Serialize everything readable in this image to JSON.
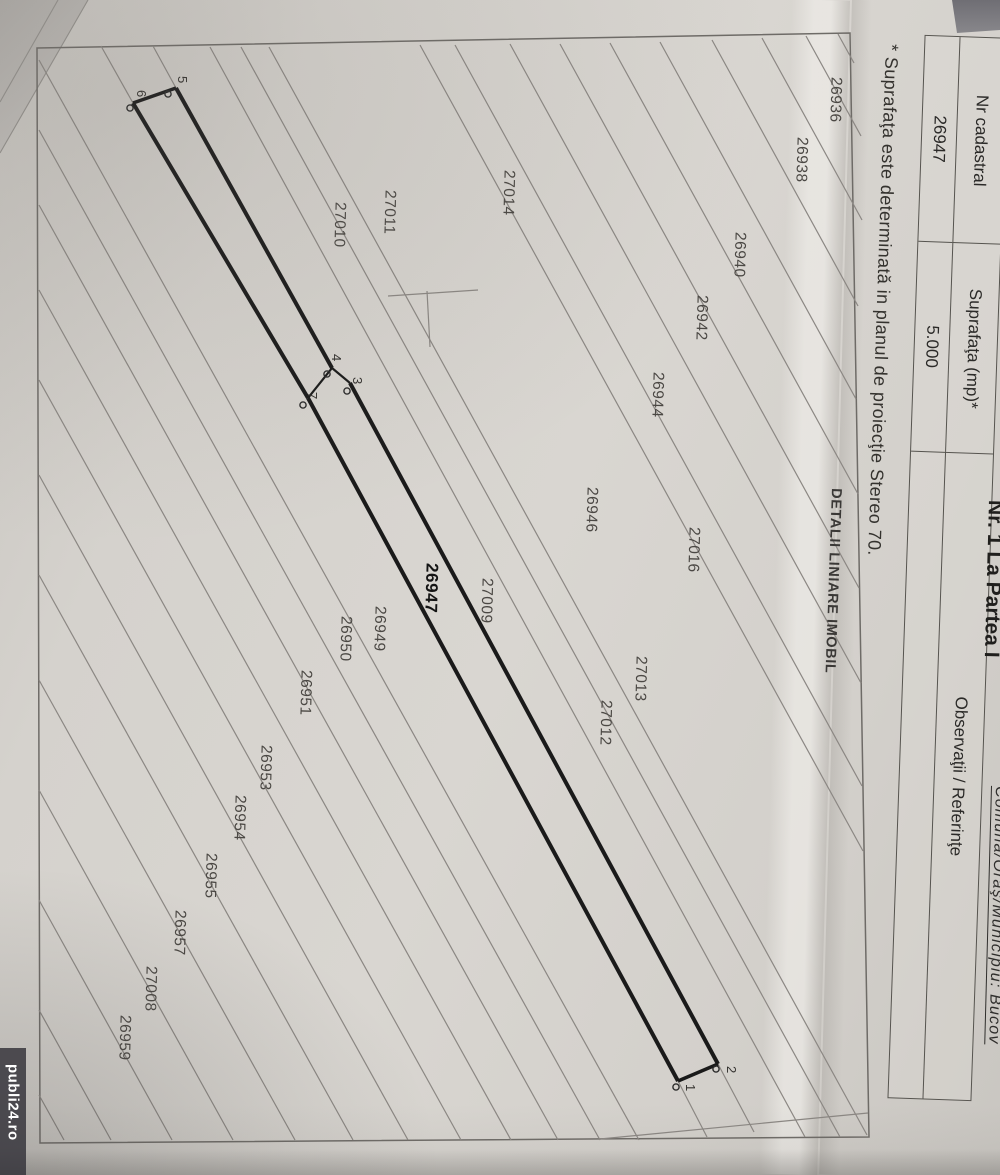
{
  "photo": {
    "watermark": "publi24.ro"
  },
  "header": {
    "part_title": "Nr. 1 La Partea I",
    "location": "Comuna/Oraş/Municipiu: Bucov"
  },
  "table": {
    "rows": [
      {
        "header": "Nr cadastral",
        "value": "26947"
      },
      {
        "header": "Suprafaţa (mp)*",
        "value": "5.000"
      },
      {
        "header": "Observaţii / Referinţe",
        "value": ""
      }
    ]
  },
  "note": "* Suprafaţa este determinată in planul de proiecţie Stereo 70.",
  "section_title": "DETALII LINIARE IMOBIL",
  "colors": {
    "paper": "#d6d3ce",
    "ink": "#2f2d2a",
    "parcel_line": "#8b8783",
    "highlight_line": "#1a1a1a",
    "watermark_bg": "#323138",
    "watermark_text": "#ffffff"
  },
  "map": {
    "highlight_parcel": "26947",
    "parcel_labels": [
      {
        "label": "26936",
        "x": 826,
        "y": 77
      },
      {
        "label": "26938",
        "x": 792,
        "y": 137
      },
      {
        "label": "26940",
        "x": 730,
        "y": 232
      },
      {
        "label": "26942",
        "x": 692,
        "y": 295
      },
      {
        "label": "26944",
        "x": 648,
        "y": 372
      },
      {
        "label": "27014",
        "x": 499,
        "y": 170
      },
      {
        "label": "27011",
        "x": 380,
        "y": 190
      },
      {
        "label": "27010",
        "x": 330,
        "y": 202
      },
      {
        "label": "26946",
        "x": 582,
        "y": 487
      },
      {
        "label": "27016",
        "x": 684,
        "y": 527
      },
      {
        "label": "27013",
        "x": 631,
        "y": 656
      },
      {
        "label": "27012",
        "x": 596,
        "y": 700
      },
      {
        "label": "26947",
        "x": 421,
        "y": 563,
        "bold": true
      },
      {
        "label": "27009",
        "x": 477,
        "y": 578
      },
      {
        "label": "26949",
        "x": 370,
        "y": 606
      },
      {
        "label": "26950",
        "x": 336,
        "y": 616
      },
      {
        "label": "26951",
        "x": 296,
        "y": 670
      },
      {
        "label": "26953",
        "x": 256,
        "y": 745
      },
      {
        "label": "26954",
        "x": 230,
        "y": 795
      },
      {
        "label": "26955",
        "x": 201,
        "y": 853
      },
      {
        "label": "26957",
        "x": 170,
        "y": 910
      },
      {
        "label": "27008",
        "x": 141,
        "y": 966
      },
      {
        "label": "26959",
        "x": 115,
        "y": 1015
      }
    ],
    "vertex_labels": [
      {
        "label": "5",
        "x": 175,
        "y": 76
      },
      {
        "label": "6",
        "x": 134,
        "y": 90
      },
      {
        "label": "4",
        "x": 329,
        "y": 354
      },
      {
        "label": "3",
        "x": 350,
        "y": 377
      },
      {
        "label": "7",
        "x": 305,
        "y": 392
      },
      {
        "label": "1",
        "x": 683,
        "y": 1084
      },
      {
        "label": "2",
        "x": 724,
        "y": 1066
      }
    ]
  }
}
